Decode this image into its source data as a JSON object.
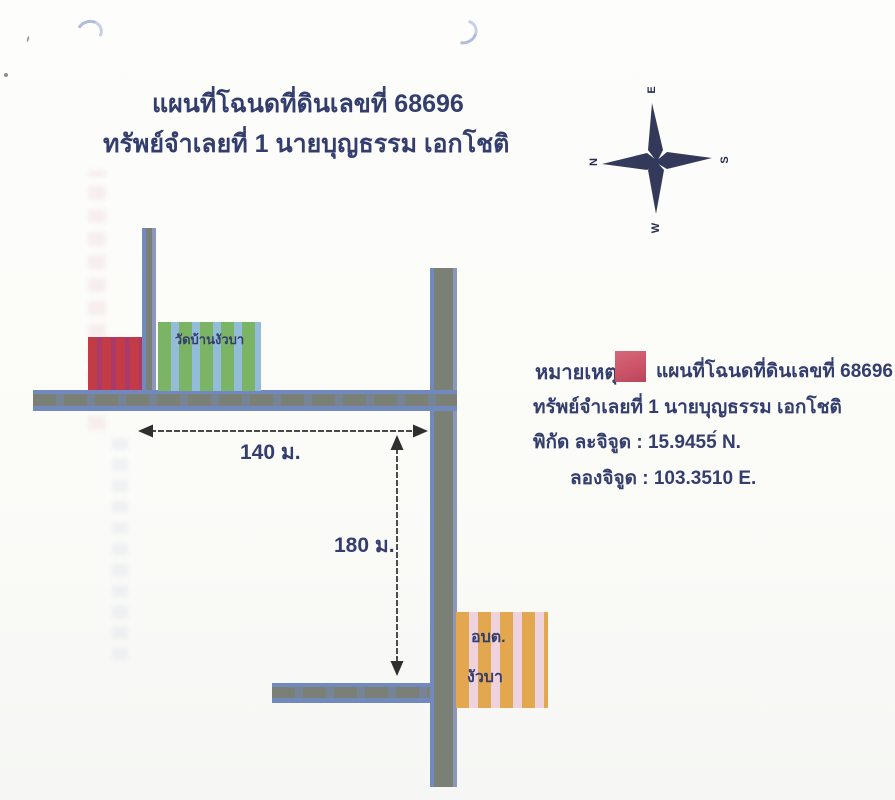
{
  "document": {
    "title_line1": "แผนที่โฉนดที่ดินเลขที่ 68696",
    "title_line2": "ทรัพย์จำเลยที่ 1 นายบุญธรรม  เอกโชติ"
  },
  "compass": {
    "n": "N",
    "s": "S",
    "e": "E",
    "w": "W"
  },
  "map": {
    "temple_label": "วัดบ้านงัวบา",
    "sao_label_line1": "อบต.",
    "sao_label_line2": "งัวบา",
    "distance_horizontal": "140 ม.",
    "distance_vertical": "180 ม."
  },
  "legend": {
    "note_label": "หมายเหตุ",
    "line1": "แผนที่โฉนดที่ดินเลขที่ 68696",
    "line2": "ทรัพย์จำเลยที่ 1 นายบุญธรรม  เอกโชติ",
    "latitude": "พิกัด ละจิจูด :  15.9455́ N.",
    "longitude": "ลองจิจูด : 103.3510 E."
  },
  "colors": {
    "navy": "#343e6e",
    "ink": "#2f2f2f",
    "road_gray": "#7a8076",
    "road_blue": "#7289bd",
    "red": "#c23b45",
    "red_stripe": "#a93a69",
    "green": "#7cb465",
    "green_stripe": "#93bcd8",
    "orange": "#e3a74f",
    "orange_stripe": "#eed2dd",
    "legend_red": "#cc5368"
  }
}
